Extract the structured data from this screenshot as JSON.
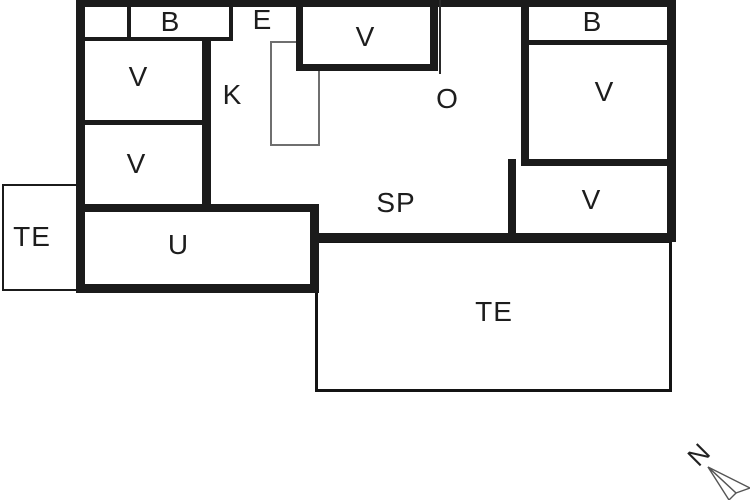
{
  "colors": {
    "wall": "#1b1b1b",
    "background": "#ffffff",
    "thin_line": "#6f6f6f",
    "label": "#1d1d1d"
  },
  "rooms": {
    "b_top_left": {
      "label": "B"
    },
    "entrance": {
      "label": "E"
    },
    "v_top_middle": {
      "label": "V"
    },
    "b_top_right": {
      "label": "B"
    },
    "v_left_upper": {
      "label": "V"
    },
    "v_left_lower": {
      "label": "V"
    },
    "v_right_upper": {
      "label": "V"
    },
    "v_right_lower": {
      "label": "V"
    },
    "kitchen": {
      "label": "K"
    },
    "living_room": {
      "label": "O"
    },
    "sp_room": {
      "label": "SP"
    },
    "utility": {
      "label": "U"
    },
    "terrace_left": {
      "label": "TE"
    },
    "terrace_main": {
      "label": "TE"
    }
  },
  "compass": {
    "north_label": "N"
  }
}
